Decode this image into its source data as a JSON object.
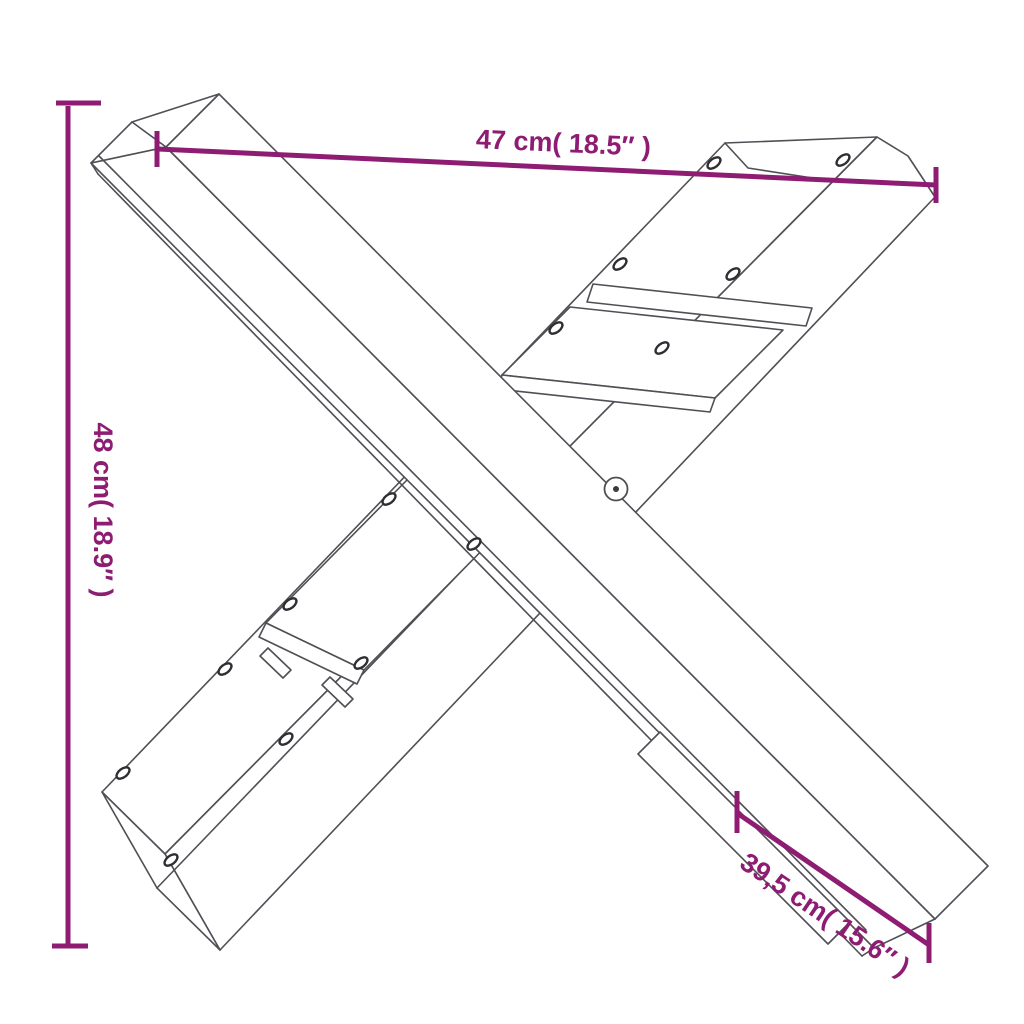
{
  "diagram": {
    "type": "product-dimension-drawing",
    "background": "#ffffff",
    "wireframe_color": "#4f4f55",
    "dimension_color": "#8d1c72",
    "dimensions": {
      "width": {
        "label": "47 cm( 18.5″ )"
      },
      "height": {
        "label": "48 cm( 18.9″ )"
      },
      "depth": {
        "label": "39,5 cm( 15.6″ )"
      }
    }
  }
}
